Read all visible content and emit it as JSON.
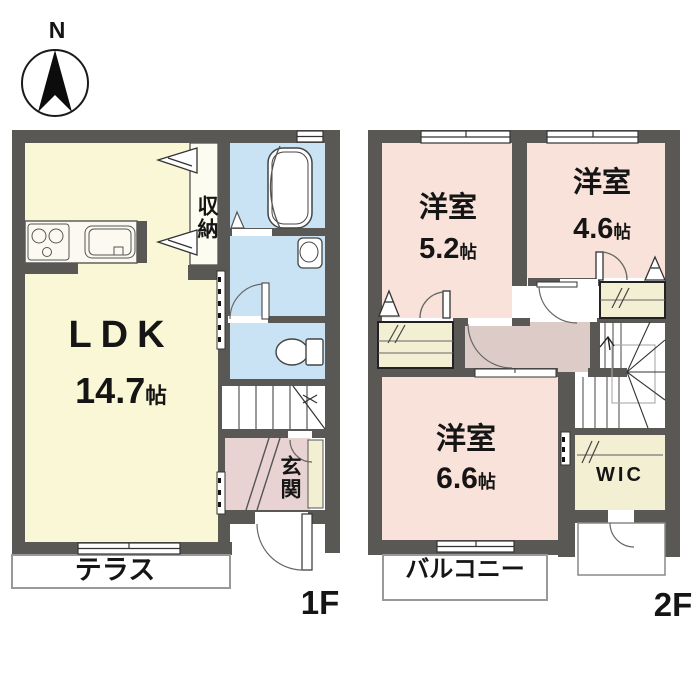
{
  "title": "apartment-floorplan",
  "compass": {
    "label": "N"
  },
  "floor1": {
    "floor_label": "1F",
    "rooms": {
      "ldk": {
        "name": "LDK",
        "size": "14.7",
        "size_unit": "帖"
      },
      "storage": {
        "name": "収納"
      },
      "entrance": {
        "name": "玄関"
      },
      "terrace": {
        "name": "テラス"
      }
    }
  },
  "floor2": {
    "floor_label": "2F",
    "rooms": {
      "bedroom1": {
        "name": "洋室",
        "size": "5.2",
        "size_unit": "帖"
      },
      "bedroom2": {
        "name": "洋室",
        "size": "4.6",
        "size_unit": "帖"
      },
      "bedroom3": {
        "name": "洋室",
        "size": "6.6",
        "size_unit": "帖"
      },
      "wic": {
        "name": "WIC"
      },
      "balcony": {
        "name": "バルコニー"
      }
    }
  },
  "colors": {
    "wall": "#595855",
    "ldk_fill": "#f9f7d5",
    "wet_fill": "#c9e3f4",
    "bedroom_fill": "#f8e2d9",
    "hall_fill": "#dccbc7",
    "entrance_fill": "#e9d2d2",
    "closet_fill": "#f3efd3",
    "outline": "#3a3a3a"
  }
}
